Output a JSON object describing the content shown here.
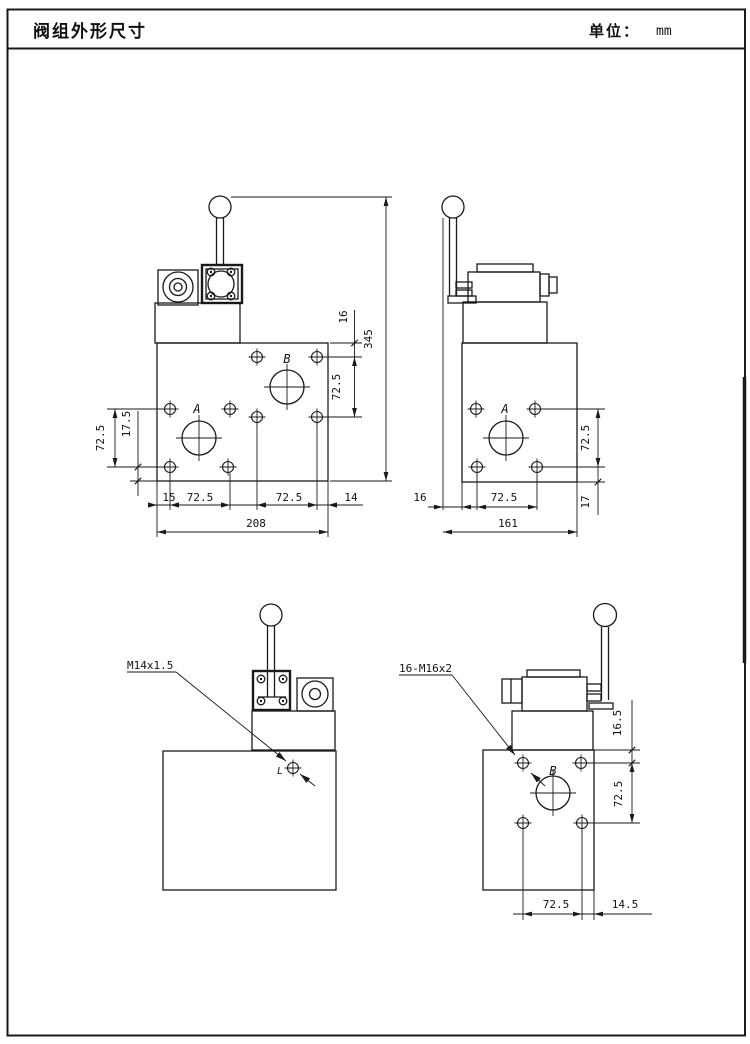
{
  "title_bar": {
    "title": "阀组外形尺寸",
    "unit_label": "单位：",
    "unit_value": "mm"
  },
  "front_view": {
    "port_a": "A",
    "port_b": "B",
    "dim_overall_height": "345",
    "dim_top_to_hole": "16",
    "dim_right_hole_spacing": "72.5",
    "dim_left_hole_spacing": "72.5",
    "dim_hole_to_bottom": "17.5",
    "dim_left_margin": "15",
    "dim_a_hole_span": "72.5",
    "dim_b_hole_span": "72.5",
    "dim_right_margin": "14",
    "dim_overall_width": "208"
  },
  "side_view": {
    "port_a": "A",
    "dim_lever_to_edge": "16",
    "dim_hole_span": "72.5",
    "dim_overall_width": "161",
    "dim_hole_spacing": "72.5",
    "dim_hole_to_bottom": "17"
  },
  "rear_view": {
    "thread_callout": "M14x1.5",
    "port_l": "L"
  },
  "side_b_view": {
    "thread_callout": "16-M16x2",
    "dim_top_to_hole": "16.5",
    "dim_hole_spacing": "72.5",
    "dim_hole_span": "72.5",
    "dim_right_margin": "14.5",
    "port_b": "B"
  }
}
